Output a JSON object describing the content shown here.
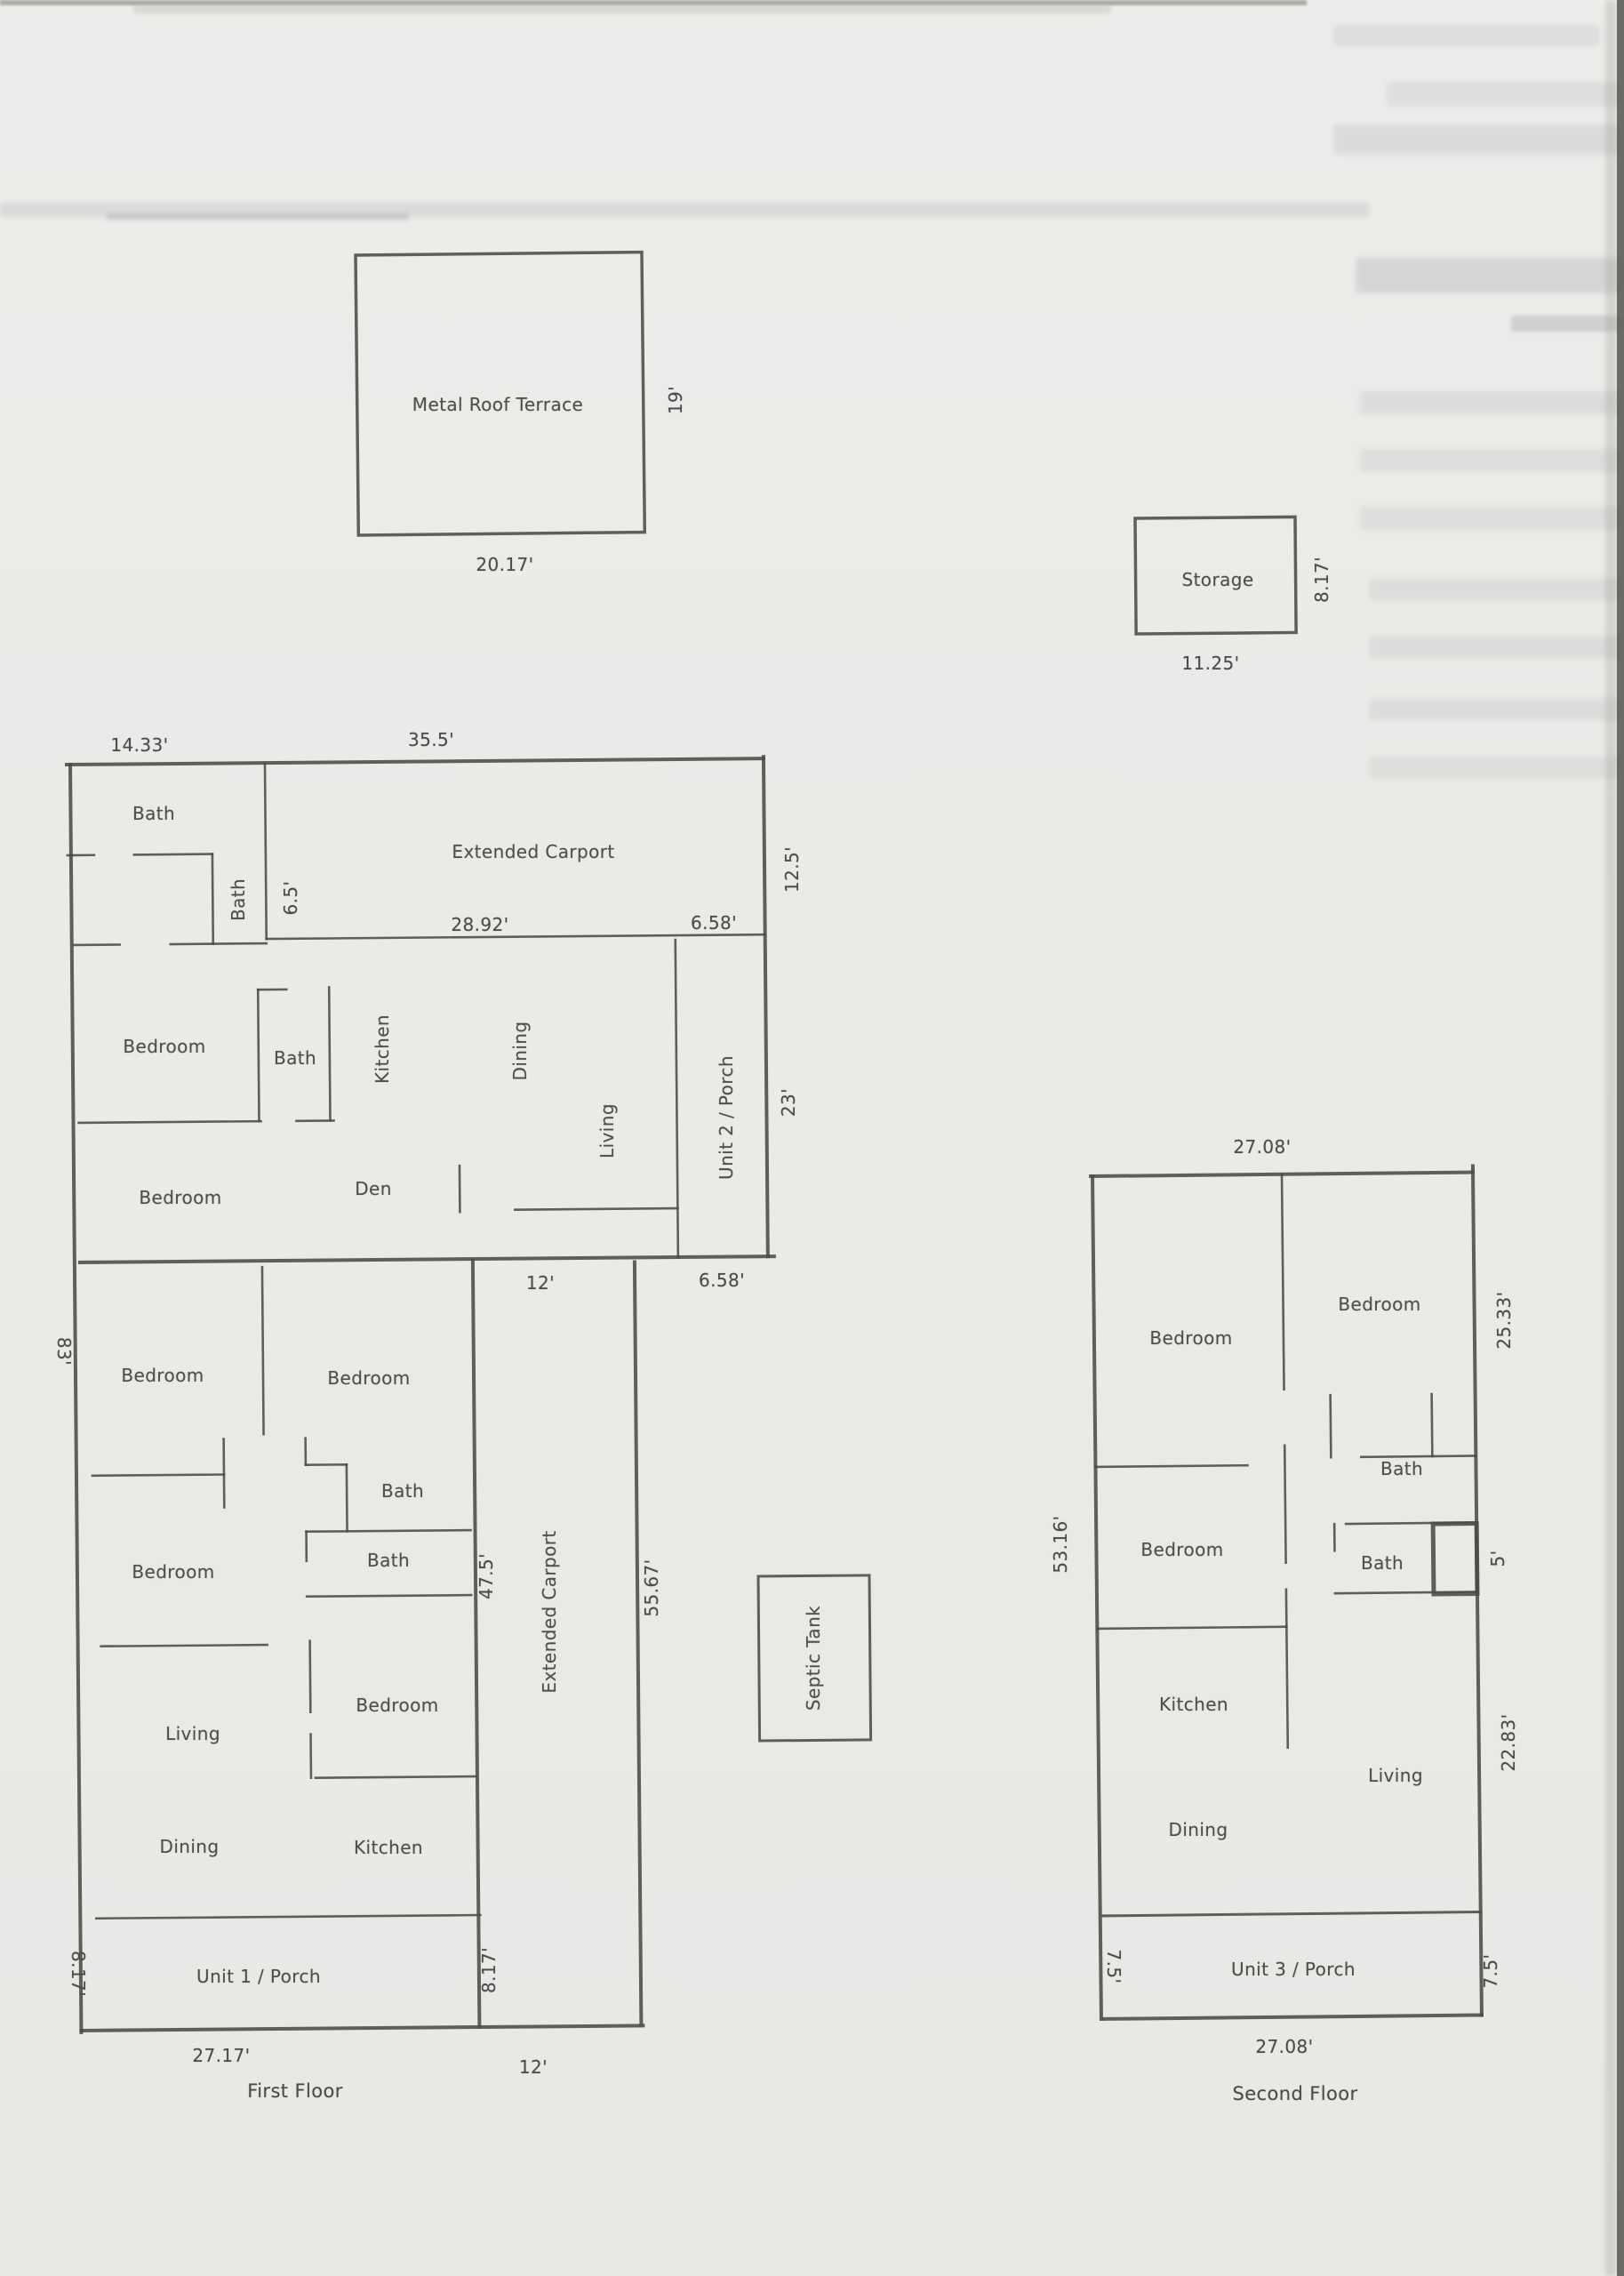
{
  "terrace": {
    "label": "Metal Roof Terrace",
    "width_dim": "20.17'",
    "height_dim": "19'"
  },
  "storage": {
    "label": "Storage",
    "width_dim": "11.25'",
    "height_dim": "8.17'"
  },
  "septic": {
    "label": "Septic Tank"
  },
  "first_floor": {
    "caption": "First Floor",
    "rooms": {
      "bath_top": "Bath",
      "bath_small": "Bath",
      "carport_top": "Extended Carport",
      "bedroom_1": "Bedroom",
      "bath_mid": "Bath",
      "kitchen_1": "Kitchen",
      "dining_1": "Dining",
      "living_1": "Living",
      "unit2_porch": "Unit 2 / Porch",
      "bedroom_2": "Bedroom",
      "den": "Den",
      "bedroom_3": "Bedroom",
      "bedroom_4": "Bedroom",
      "bath_3": "Bath",
      "bath_4": "Bath",
      "bedroom_5": "Bedroom",
      "carport_side": "Extended Carport",
      "living_2": "Living",
      "bedroom_6": "Bedroom",
      "kitchen_2": "Kitchen",
      "dining_2": "Dining",
      "unit1_porch": "Unit 1 / Porch"
    },
    "dims": {
      "top_left": "14.33'",
      "top_mid": "35.5'",
      "carport_w": "28.92'",
      "porch2_top": "6.58'",
      "carport_h": "12.5'",
      "bath_small_h": "6.5'",
      "mid_bottom": "12'",
      "porch2_bottom": "6.58'",
      "porch2_h": "23'",
      "left_h": "83'",
      "right_h": "47.5'",
      "carport_side_h": "55.67'",
      "porch1_left": "8.17'",
      "porch1_right": "8.17'",
      "bottom_w": "27.17'",
      "carport_bottom": "12'"
    }
  },
  "second_floor": {
    "caption": "Second Floor",
    "rooms": {
      "bedroom_1": "Bedroom",
      "bedroom_2": "Bedroom",
      "bath_1": "Bath",
      "bath_2": "Bath",
      "bedroom_3": "Bedroom",
      "kitchen": "Kitchen",
      "living": "Living",
      "dining": "Dining",
      "unit3_porch": "Unit 3 / Porch"
    },
    "dims": {
      "top_w": "27.08'",
      "right_upper": "25.33'",
      "closet": "5'",
      "left_h": "53.16'",
      "right_lower": "22.83'",
      "porch_left": "7.5'",
      "porch_right": "7.5'",
      "bottom_w": "27.08'"
    }
  }
}
